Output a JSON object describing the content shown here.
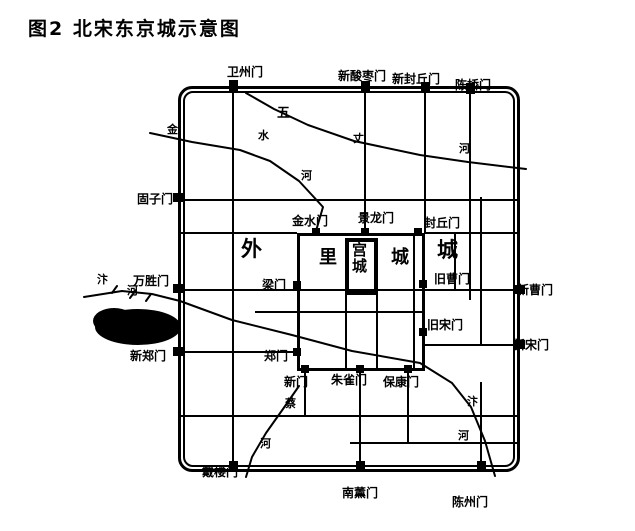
{
  "figure": {
    "title": "图2  北宋东京城示意图"
  },
  "map": {
    "city_labels": {
      "outer_left": "外",
      "outer_right": "城",
      "inner_left": "里",
      "inner_right": "城",
      "palace": "宫城"
    },
    "gates": {
      "outer": {
        "top": [
          "卫州门",
          "新酸枣门",
          "新封丘门",
          "陈桥门"
        ],
        "left": [
          "固子门",
          "万胜门",
          "新郑门"
        ],
        "right": [
          "新曹门",
          "新宋门"
        ],
        "bottom": [
          "戴楼门",
          "南薰门",
          "陈州门"
        ]
      },
      "inner": {
        "north": [
          "金水门",
          "景龙门",
          "封丘门"
        ],
        "west": [
          "梁门",
          "郑门"
        ],
        "east": [
          "旧曹门",
          "旧宋门"
        ],
        "south": [
          "新门",
          "朱雀门",
          "保康门"
        ]
      }
    },
    "rivers": {
      "jinshui": [
        "金",
        "水",
        "河"
      ],
      "wuzhang": [
        "五",
        "丈",
        "河"
      ],
      "bian_west": [
        "汴",
        "河"
      ],
      "bian_southeast": [
        "汴",
        "河"
      ],
      "cai": [
        "蔡",
        "河"
      ]
    }
  }
}
